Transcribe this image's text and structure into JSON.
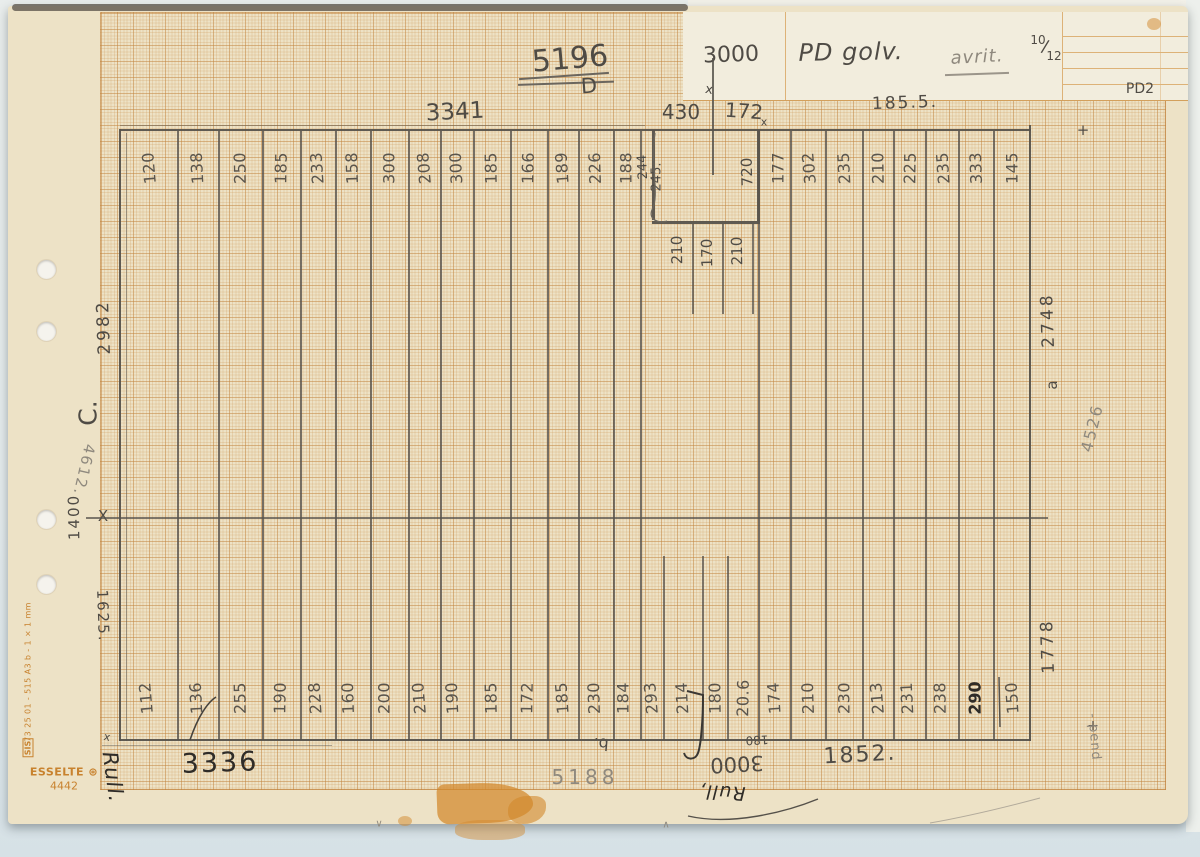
{
  "header_card": {
    "measure": "3000",
    "title": "PD golv.",
    "note": "avrit.",
    "date_top": "10",
    "date_slash": "/",
    "date_bottom": "12",
    "code": "PD2"
  },
  "top": {
    "big_number": "5196",
    "letter": "D",
    "width_left": "3341",
    "notch_left": "430",
    "notch_right": "172",
    "notch_sub": "x",
    "width_right": "185.5.",
    "tick": "x",
    "plus": "+"
  },
  "columns": {
    "top_values": [
      "120",
      "138",
      "250",
      "185",
      "233",
      "158",
      "300",
      "208",
      "300",
      "185",
      "166",
      "189",
      "226",
      "188"
    ],
    "top_right_values": [
      "177",
      "302",
      "235",
      "210",
      "225",
      "235",
      "333",
      "145"
    ],
    "bottom_values": [
      "112",
      "136",
      "255",
      "190",
      "228",
      "160",
      "200",
      "210",
      "190",
      "185",
      "172",
      "185",
      "230",
      "184",
      "293",
      "214",
      "180",
      "20.6",
      "174",
      "210",
      "230",
      "213",
      "231",
      "238",
      "290",
      "150"
    ]
  },
  "notch": {
    "side_a": "244",
    "side_b": "245.",
    "inner": "720",
    "below": [
      "210",
      "170",
      "210"
    ]
  },
  "left_margin": {
    "dim_top": "2982",
    "letter": "C.",
    "faint": "4612.",
    "dim_mid": "1400",
    "x_mark": "X",
    "dim_bottom": "1625.",
    "corner_tick": "x"
  },
  "right_margin": {
    "dim_top": "2748",
    "suffix": "a",
    "faint": "4526",
    "dim_bottom": "1778",
    "plus": "+",
    "note": "- pend"
  },
  "bottom": {
    "width_left": "3336",
    "faint_number": "5188",
    "width_right": "1852.",
    "flag": "b.",
    "measure": "3000",
    "small": "180",
    "roll_note": "Rull,",
    "ink_signature": "Rull.",
    "check_down": "∨",
    "check_up": "∧"
  },
  "print": {
    "sis": "SIS",
    "spec": "73 25 01 - 515 A3 b - 1 × 1 mm",
    "brand": "ESSELTE",
    "reg": "⊛",
    "model": "4442"
  },
  "colors": {
    "pencil": "#4f4b45",
    "ink": "#2f2c28",
    "light_pencil": "#8f897e",
    "print_orange": "#c8822e",
    "paper": "#ede2c6",
    "card": "#f2eddd"
  }
}
